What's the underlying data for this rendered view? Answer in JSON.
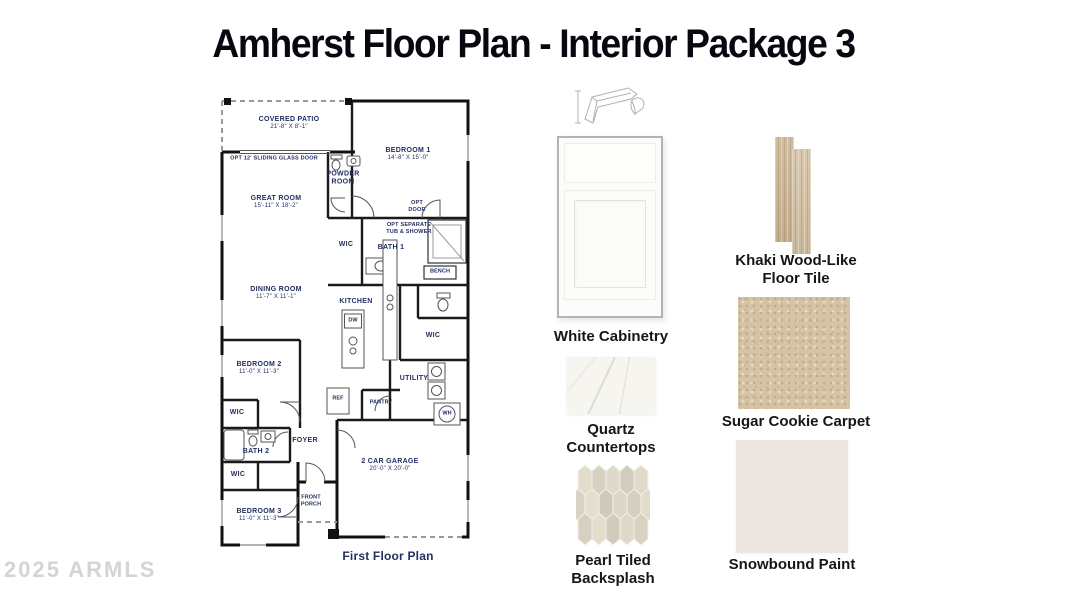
{
  "title": "Amherst Floor Plan - Interior Package 3",
  "watermark": "2025 ARMLS",
  "colors": {
    "plan_label_navy": "#232f61",
    "wall_black": "#111111",
    "cabinet_white": "#fcfcfb",
    "khaki_wood": "#ccb795",
    "quartz_white": "#f7f5f0",
    "sugar_cookie_carpet": "#d6c3a6",
    "pearl_tile": "#ddd7c7",
    "snowbound_paint": "#ece8e1"
  },
  "floor_plan": {
    "caption": "First Floor Plan",
    "rooms": [
      {
        "name": "COVERED PATIO",
        "dims": "21'-8\" X 8'-1\""
      },
      {
        "name": "BEDROOM 1",
        "dims": "14'-8\" X 15'-0\""
      },
      {
        "name": "POWDER ROOM"
      },
      {
        "name": "GREAT ROOM",
        "dims": "15'-11\" X 18'-2\""
      },
      {
        "name": "WIC"
      },
      {
        "name": "BATH 1"
      },
      {
        "name": "DINING ROOM",
        "dims": "11'-7\" X 11'-1\""
      },
      {
        "name": "KITCHEN"
      },
      {
        "name": "WIC"
      },
      {
        "name": "BEDROOM 2",
        "dims": "11'-0\" X 11'-3\""
      },
      {
        "name": "UTILITY"
      },
      {
        "name": "REF"
      },
      {
        "name": "PANTRY"
      },
      {
        "name": "WIC"
      },
      {
        "name": "BATH 2"
      },
      {
        "name": "FOYER"
      },
      {
        "name": "WIC"
      },
      {
        "name": "BEDROOM 3",
        "dims": "11'-0\" X 11'-3\""
      },
      {
        "name": "FRONT PORCH"
      },
      {
        "name": "2 CAR GARAGE",
        "dims": "20'-0\" X 20'-0\""
      },
      {
        "name": "WH"
      },
      {
        "name": "BENCH"
      },
      {
        "name": "DW"
      }
    ],
    "annotations": [
      {
        "text": "OPT 12' SLIDING GLASS DOOR"
      },
      {
        "text": "OPT DOOR"
      },
      {
        "text": "OPT SEPARATE TUB & SHOWER"
      }
    ]
  },
  "samples": [
    {
      "name": "White Cabinetry"
    },
    {
      "name": "Khaki Wood-Like Floor Tile"
    },
    {
      "name": "Quartz Countertops"
    },
    {
      "name": "Sugar Cookie Carpet"
    },
    {
      "name": "Pearl Tiled Backsplash"
    },
    {
      "name": "Snowbound Paint"
    }
  ]
}
